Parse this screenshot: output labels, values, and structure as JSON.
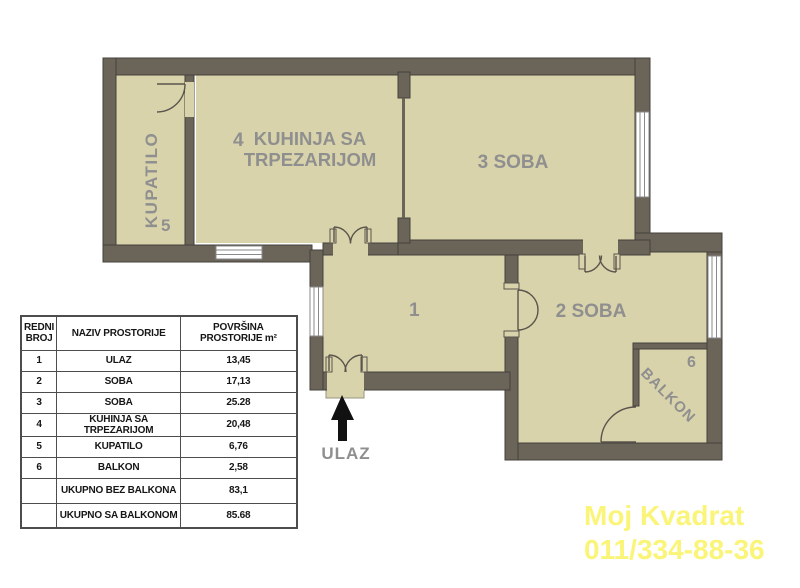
{
  "colors": {
    "wall": "#6b6459",
    "floor": "#d9d3ab",
    "label": "#8f8f8f",
    "watermark": "#faf578",
    "arrow": "#111111"
  },
  "plan": {
    "rooms": {
      "kupatilo": {
        "label": "KUPATILO",
        "number": "5"
      },
      "kitchen": {
        "number": "4",
        "label_line1": "KUHINJA SA",
        "label_line2": "TRPEZARIJOM"
      },
      "soba3": {
        "label": "3 SOBA"
      },
      "hall": {
        "number": "1"
      },
      "soba2": {
        "label": "2 SOBA"
      },
      "balkon": {
        "label": "BALKON",
        "number": "6"
      }
    },
    "entrance_label": "ULAZ"
  },
  "table": {
    "headers": [
      "REDNI BROJ",
      "NAZIV PROSTORIJE",
      "POVRŠINA PROSTORIJE m²"
    ],
    "rows": [
      {
        "no": "1",
        "name": "ULAZ",
        "area": "13,45"
      },
      {
        "no": "2",
        "name": "SOBA",
        "area": "17,13"
      },
      {
        "no": "3",
        "name": "SOBA",
        "area": "25.28"
      },
      {
        "no": "4",
        "name": "KUHINJA SA TRPEZARIJOM",
        "area": "20,48"
      },
      {
        "no": "5",
        "name": "KUPATILO",
        "area": "6,76"
      },
      {
        "no": "6",
        "name": "BALKON",
        "area": "2,58"
      },
      {
        "no": "",
        "name": "UKUPNO BEZ BALKONA",
        "area": "83,1"
      },
      {
        "no": "",
        "name": "UKUPNO SA BALKONOM",
        "area": "85.68"
      }
    ]
  },
  "watermark": {
    "line1": "Moj Kvadrat",
    "line2": "011/334-88-36"
  }
}
